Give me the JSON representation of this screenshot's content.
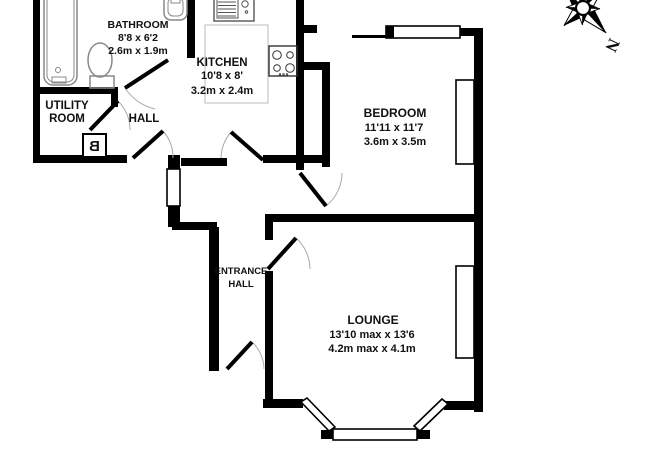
{
  "floorplan": {
    "rooms": {
      "bathroom": {
        "name": "BATHROOM",
        "dims_imperial": "8'8 x 6'2",
        "dims_metric": "2.6m x 1.9m"
      },
      "utility": {
        "name_line1": "UTILITY",
        "name_line2": "ROOM"
      },
      "hall": {
        "name": "HALL"
      },
      "kitchen": {
        "name": "KITCHEN",
        "dims_imperial": "10'8 x 8'",
        "dims_metric": "3.2m x 2.4m"
      },
      "bedroom": {
        "name": "BEDROOM",
        "dims_imperial": "11'11 x 11'7",
        "dims_metric": "3.6m x 3.5m"
      },
      "entrance_hall": {
        "name_line1": "ENTRANCE",
        "name_line2": "HALL"
      },
      "lounge": {
        "name": "LOUNGE",
        "dims_imperial": "13'10 max x 13'6",
        "dims_metric": "4.2m max x 4.1m"
      }
    },
    "boiler_label": "B",
    "compass": {
      "north_label": "N"
    },
    "fixtures": [
      "bathtub",
      "toilet",
      "wash-basin",
      "kitchen-sink",
      "hob",
      "boiler",
      "worktop"
    ],
    "colors": {
      "wall": "#000000",
      "fixture_outline": "#888888",
      "worktop_outline": "#bbbbbb",
      "door_arc": "#aaaaaa",
      "background": "#ffffff"
    }
  }
}
